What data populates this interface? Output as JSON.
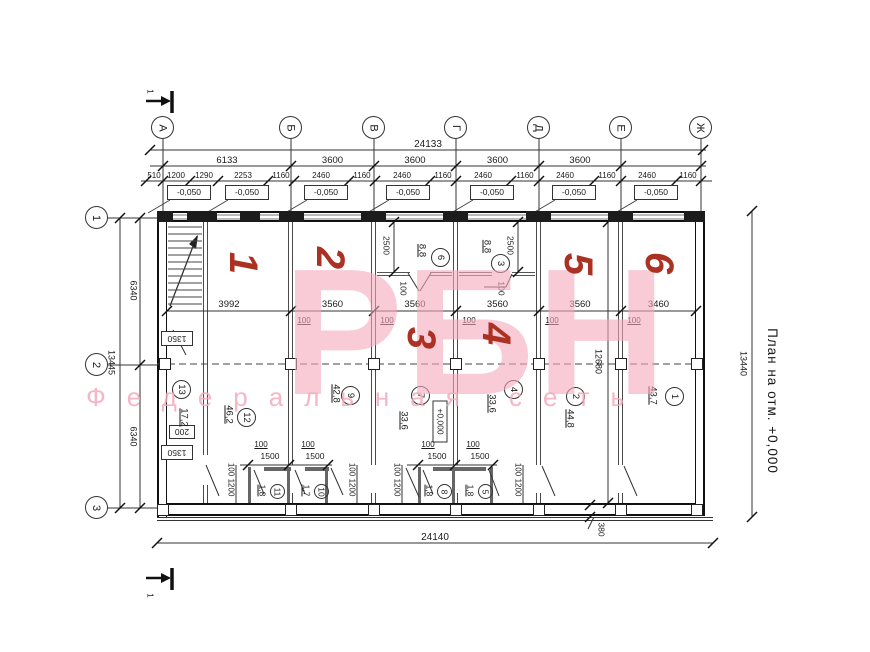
{
  "side_note": "План на отм. +0,000",
  "section_label": "1",
  "axes": {
    "cols": [
      "А",
      "Б",
      "В",
      "Г",
      "Д",
      "Е",
      "Ж"
    ],
    "rows": [
      "1",
      "2",
      "3"
    ]
  },
  "dims": {
    "overall_top": "24133",
    "bays": [
      "6133",
      "3600",
      "3600",
      "3600",
      "3600"
    ],
    "details": [
      "510",
      "1200",
      "1290",
      "2253",
      "1160",
      "2460",
      "1160",
      "2460",
      "1160",
      "2460",
      "1160",
      "2460",
      "1160",
      "2460",
      "1160"
    ],
    "elev": [
      "-0,050",
      "-0,050",
      "-0,050",
      "-0,050",
      "-0,050",
      "-0,050",
      "-0,050"
    ],
    "mid": [
      "3992",
      "3560",
      "3560",
      "3560",
      "3560",
      "3460"
    ],
    "wall": [
      "100",
      "100",
      "100",
      "100",
      "100"
    ],
    "left_upper": "6340",
    "left_lower": "6340",
    "left_overall": "13445",
    "right_overall": "13440",
    "right_inner": "12680",
    "plinth_offset": "380",
    "bottom_overall": "24140",
    "stair": [
      "1350",
      "200",
      "1350"
    ],
    "upper_depth": [
      "2500",
      "2500"
    ],
    "upper_wall": [
      "100",
      "100"
    ],
    "wc": [
      "100",
      "1500",
      "100",
      "1500",
      "100",
      "1500",
      "100",
      "1500"
    ],
    "jamb": [
      "100",
      "1200",
      "100",
      "1200",
      "100",
      "1200",
      "100",
      "1200"
    ],
    "zero_level": "+0,000"
  },
  "rooms": {
    "r1": {
      "n": "1",
      "a": "43,7"
    },
    "r2": {
      "n": "2",
      "a": "44,8"
    },
    "r3": {
      "n": "3",
      "a": "8,8"
    },
    "r4": {
      "n": "4",
      "a": "33,6"
    },
    "r5": {
      "n": "5",
      "a": "1,8"
    },
    "r6": {
      "n": "6",
      "a": "8,8"
    },
    "r7": {
      "n": "7",
      "a": "33,6"
    },
    "r8": {
      "n": "8",
      "a": "1,8"
    },
    "r9": {
      "n": "9",
      "a": "42,8"
    },
    "r10": {
      "n": "10",
      "a": "1,7"
    },
    "r11": {
      "n": "11",
      "a": "1,8"
    },
    "r12": {
      "n": "12",
      "a": "46,2"
    },
    "r13": {
      "n": "13",
      "a": "17,2"
    }
  },
  "red_marks": [
    "1",
    "2",
    "3",
    "4",
    "5",
    "6"
  ],
  "watermark": {
    "big": "РБН",
    "sub": "Федеральная сеть"
  },
  "colors": {
    "red": "#ab3123",
    "pink": "#f3a9bb"
  }
}
